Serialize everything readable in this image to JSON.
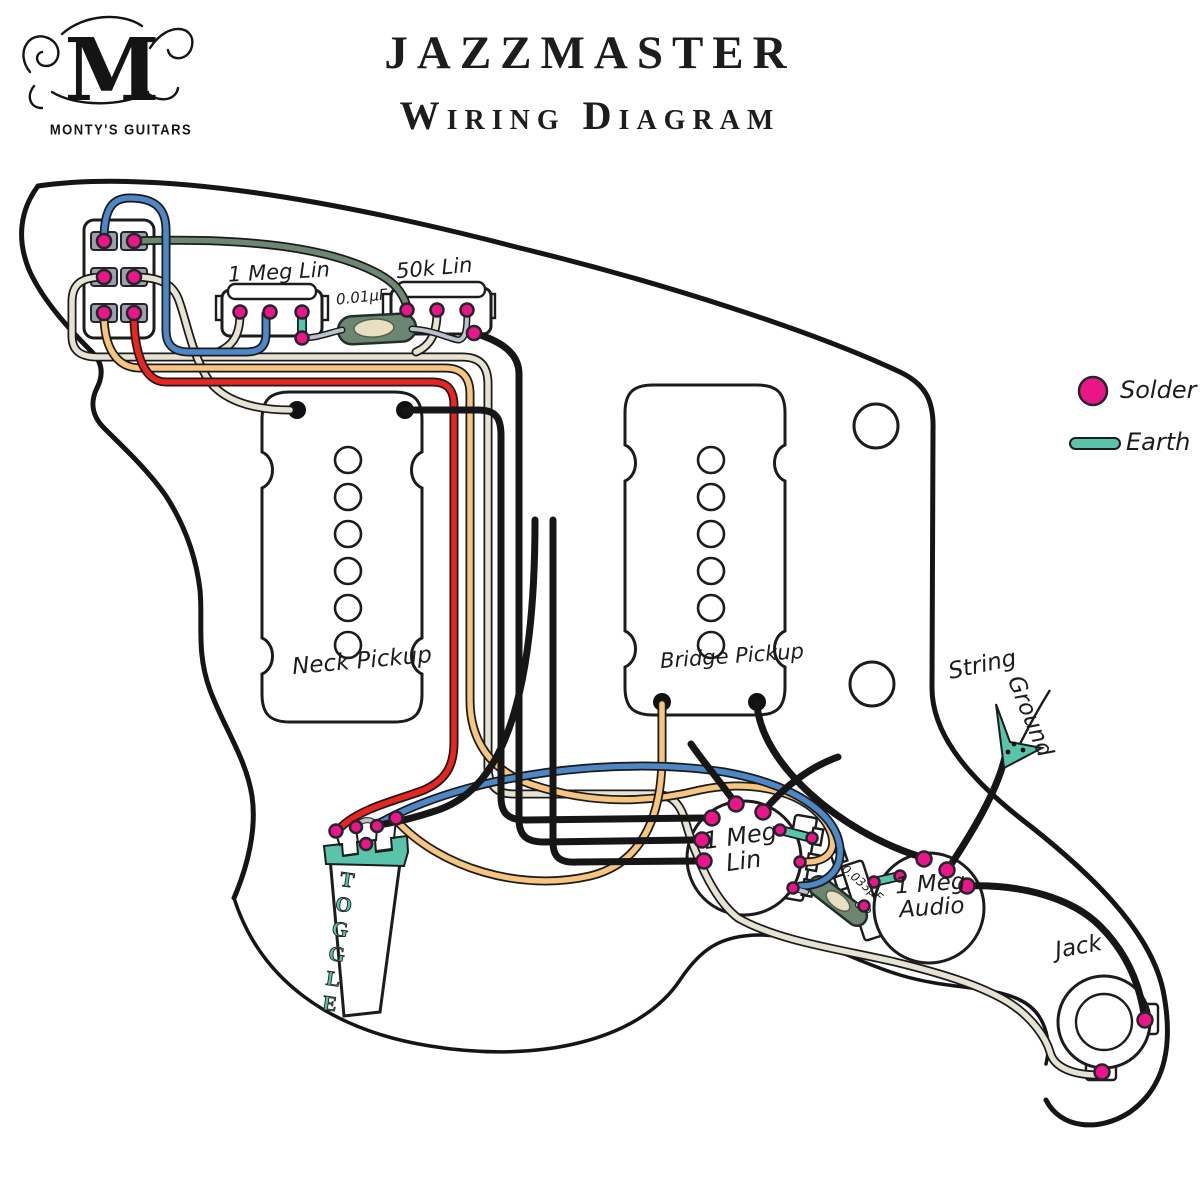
{
  "header": {
    "brand": "MONTY'S GUITARS",
    "monogram": "M",
    "title_line1": "JAZZMASTER",
    "title_line2": "Wiring Diagram"
  },
  "legend": {
    "solder_label": "Solder",
    "earth_label": "Earth",
    "solder_color": "#ea1689",
    "earth_color": "#5ac3ab"
  },
  "components": {
    "rhythm_roller_volume": {
      "label": "1 Meg Lin"
    },
    "rhythm_roller_tone": {
      "label": "50k Lin"
    },
    "rhythm_capacitor": {
      "label": "0.01µF"
    },
    "neck_pickup": {
      "label": "Neck Pickup"
    },
    "bridge_pickup": {
      "label": "Bridge Pickup"
    },
    "toggle_switch": {
      "label": "TOGGLE"
    },
    "volume_pot": {
      "label_line1": "1 Meg",
      "label_line2": "Lin"
    },
    "tone_capacitor": {
      "label": "0.033µF"
    },
    "tone_pot": {
      "label_line1": "1 Meg",
      "label_line2": "Audio"
    },
    "output_jack": {
      "label": "Jack"
    },
    "string_ground": {
      "label_line1": "String",
      "label_line2": "Ground"
    }
  },
  "wire_colors": {
    "black": "#161616",
    "red": "#ec2420",
    "orange": "#f6c57f",
    "cream": "#e7e3d4",
    "blue": "#4e87c6",
    "green": "#6e8772",
    "gray": "#bac3cb",
    "earth_teal": "#5ac3ab"
  }
}
